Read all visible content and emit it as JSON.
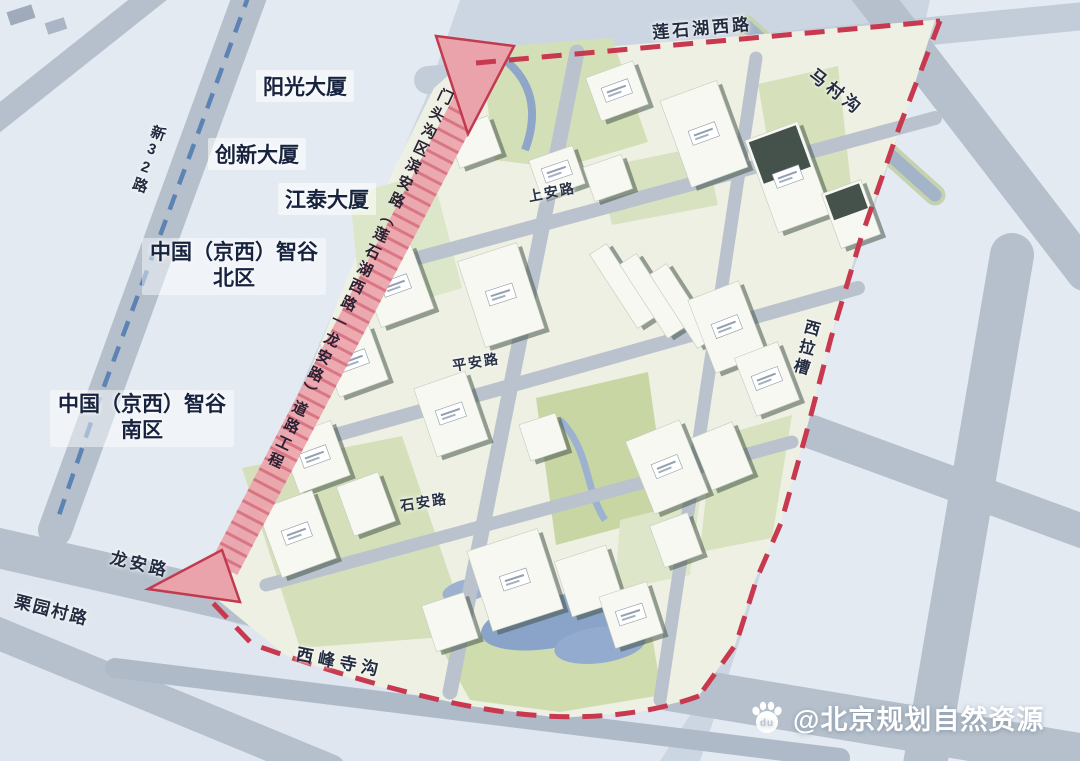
{
  "map": {
    "type": "urban-planning-master-plan",
    "district": "门头沟区",
    "construction_strip_label": "门头沟区滨安路（莲石湖西路—龙安路）道路工程",
    "building_labels": [
      "阳光大厦",
      "创新大厦",
      "江泰大厦"
    ],
    "area_labels": [
      {
        "line1": "中国（京西）智谷",
        "line2": "北区"
      },
      {
        "line1": "中国（京西）智谷",
        "line2": "南区"
      }
    ],
    "roads": {
      "lianshihu_west": "莲石湖西路",
      "macungou": "马村沟",
      "xilacao": "西拉槽",
      "longan": "龙安路",
      "liyuancun": "栗园村路",
      "xifengsigou": "西峰寺沟",
      "xin32": "新32路",
      "shangan": "上安路",
      "pingan": "平安路",
      "shian": "石安路"
    }
  },
  "watermark": {
    "handle": "@北京规划自然资源",
    "icon": "baidu-paw-icon",
    "icon_text": "du"
  },
  "colors": {
    "background": "#ccd6e2",
    "context_block": "#e7ecf4",
    "road": "#b5c0cc",
    "site_base": "#edf0e2",
    "green": "#d5e0ba",
    "water": "#8aa3c9",
    "boundary_red": "#c8394f",
    "strip_pink": "#eba3ab",
    "blue_dash": "#5d83b4",
    "label_text": "#17233e",
    "watermark_text": "#ffffff"
  }
}
